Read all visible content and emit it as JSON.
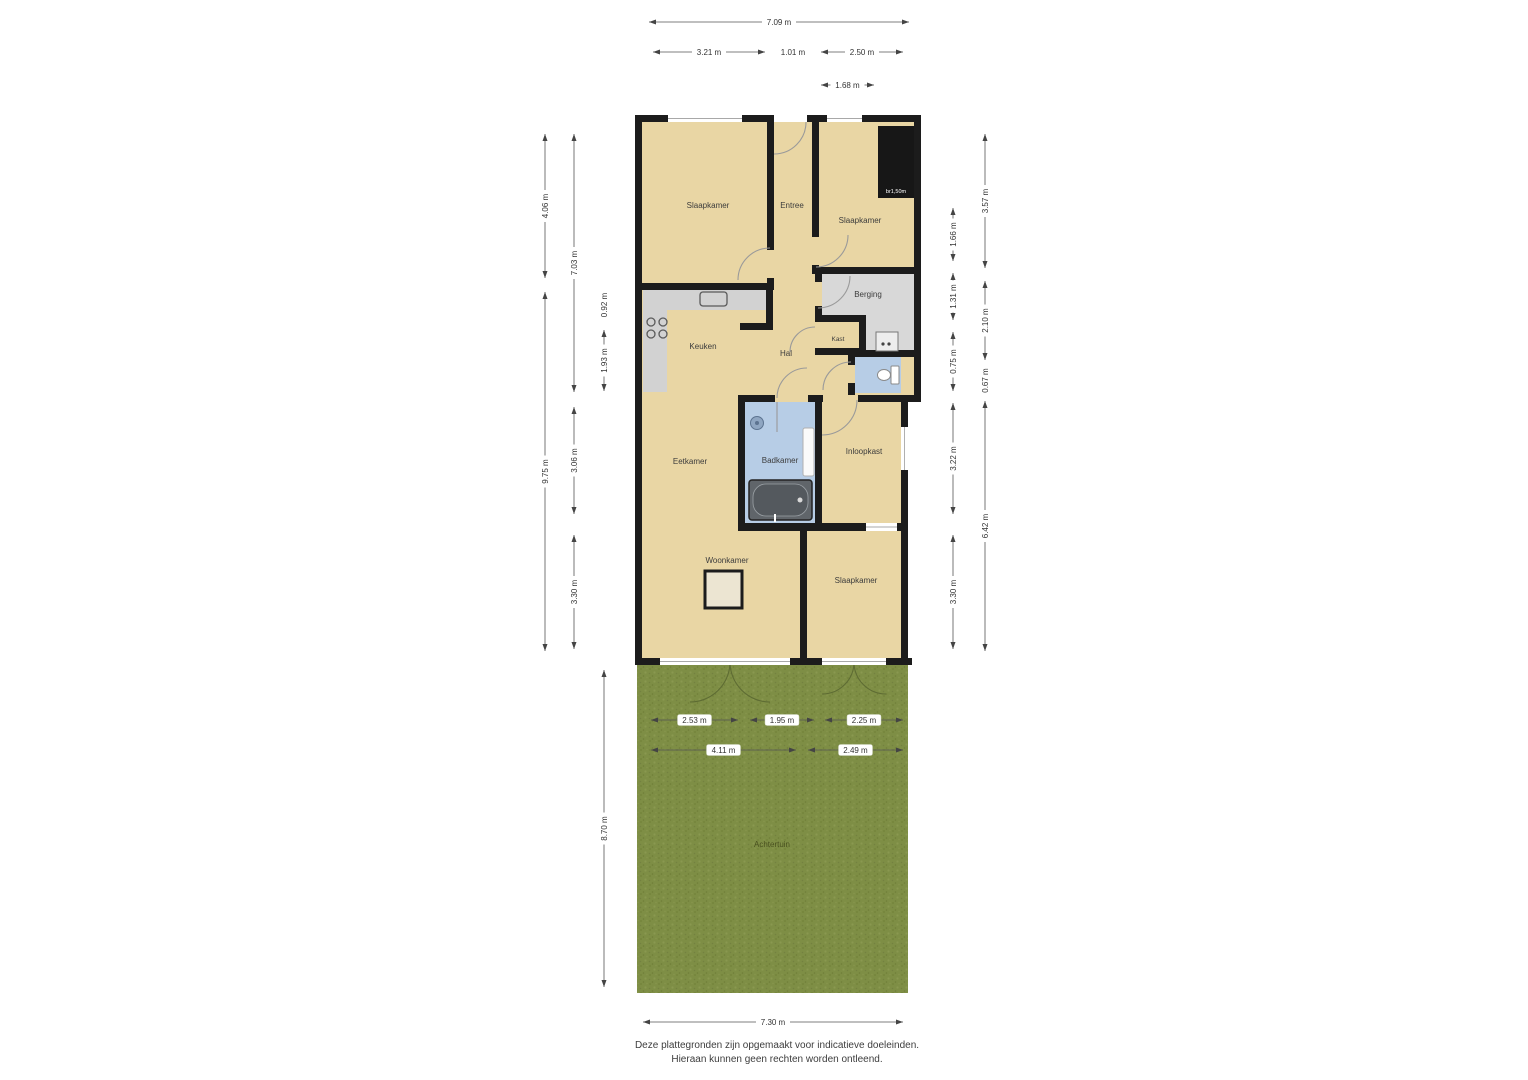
{
  "rooms": {
    "slaapkamer1": "Slaapkamer",
    "entree": "Entree",
    "slaapkamer2": "Slaapkamer",
    "berging": "Berging",
    "keuken": "Keuken",
    "hal": "Hal",
    "kast": "Kast",
    "eetkamer": "Eetkamer",
    "badkamer": "Badkamer",
    "inloopkast": "Inloopkast",
    "woonkamer": "Woonkamer",
    "slaapkamer3": "Slaapkamer",
    "achtertuin": "Achtertuin"
  },
  "annotations": {
    "closet": "br1,50m"
  },
  "disclaimer": {
    "line1": "Deze plattegronden zijn opgemaakt voor indicatieve doeleinden.",
    "line2": "Hieraan kunnen geen rechten worden ontleend."
  },
  "colors": {
    "floor": "#e9d6a4",
    "wall": "#1c1c1c",
    "wet_room": "#b7cde6",
    "storage": "#d8d8d8",
    "grass": "#7e8e45"
  },
  "dimensions": {
    "top": [
      {
        "label": "7.09 m",
        "x1": 646,
        "x2": 912,
        "y": 22
      },
      {
        "label": "3.21 m",
        "x1": 650,
        "x2": 768,
        "y": 52
      },
      {
        "label": "1.01 m",
        "x1": 774,
        "x2": 812,
        "y": 52
      },
      {
        "label": "2.50 m",
        "x1": 818,
        "x2": 906,
        "y": 52
      },
      {
        "label": "1.68 m",
        "x1": 818,
        "x2": 877,
        "y": 85
      }
    ],
    "bottom": [
      {
        "label": "7.30 m",
        "x1": 640,
        "x2": 906,
        "y": 1022
      }
    ],
    "garden": [
      {
        "label": "2.53 m",
        "x1": 648,
        "x2": 741,
        "y": 720
      },
      {
        "label": "1.95 m",
        "x1": 747,
        "x2": 817,
        "y": 720
      },
      {
        "label": "2.25 m",
        "x1": 822,
        "x2": 906,
        "y": 720
      },
      {
        "label": "4.11 m",
        "x1": 648,
        "x2": 799,
        "y": 750
      },
      {
        "label": "2.49 m",
        "x1": 805,
        "x2": 906,
        "y": 750
      }
    ],
    "left": [
      {
        "label": "4.06 m",
        "x": 545,
        "y1": 131,
        "y2": 281
      },
      {
        "label": "9.75 m",
        "x": 545,
        "y1": 289,
        "y2": 654
      },
      {
        "label": "7.03 m",
        "x": 574,
        "y1": 131,
        "y2": 395
      },
      {
        "label": "3.06 m",
        "x": 574,
        "y1": 404,
        "y2": 517
      },
      {
        "label": "3.30 m",
        "x": 574,
        "y1": 532,
        "y2": 652
      },
      {
        "label": "0.92 m",
        "x": 604,
        "y1": 287,
        "y2": 323
      },
      {
        "label": "1.93 m",
        "x": 604,
        "y1": 327,
        "y2": 394
      },
      {
        "label": "8.70 m",
        "x": 604,
        "y1": 667,
        "y2": 990
      }
    ],
    "right": [
      {
        "label": "1.66 m",
        "x": 953,
        "y1": 205,
        "y2": 264
      },
      {
        "label": "1.31 m",
        "x": 953,
        "y1": 270,
        "y2": 323
      },
      {
        "label": "0.75 m",
        "x": 953,
        "y1": 329,
        "y2": 394
      },
      {
        "label": "3.22 m",
        "x": 953,
        "y1": 400,
        "y2": 517
      },
      {
        "label": "3.30 m",
        "x": 953,
        "y1": 532,
        "y2": 652
      },
      {
        "label": "3.57 m",
        "x": 985,
        "y1": 131,
        "y2": 271
      },
      {
        "label": "2.10 m",
        "x": 985,
        "y1": 278,
        "y2": 363
      },
      {
        "label": "0.67 m",
        "x": 985,
        "y1": 367,
        "y2": 394
      },
      {
        "label": "6.42 m",
        "x": 985,
        "y1": 398,
        "y2": 654
      }
    ]
  }
}
